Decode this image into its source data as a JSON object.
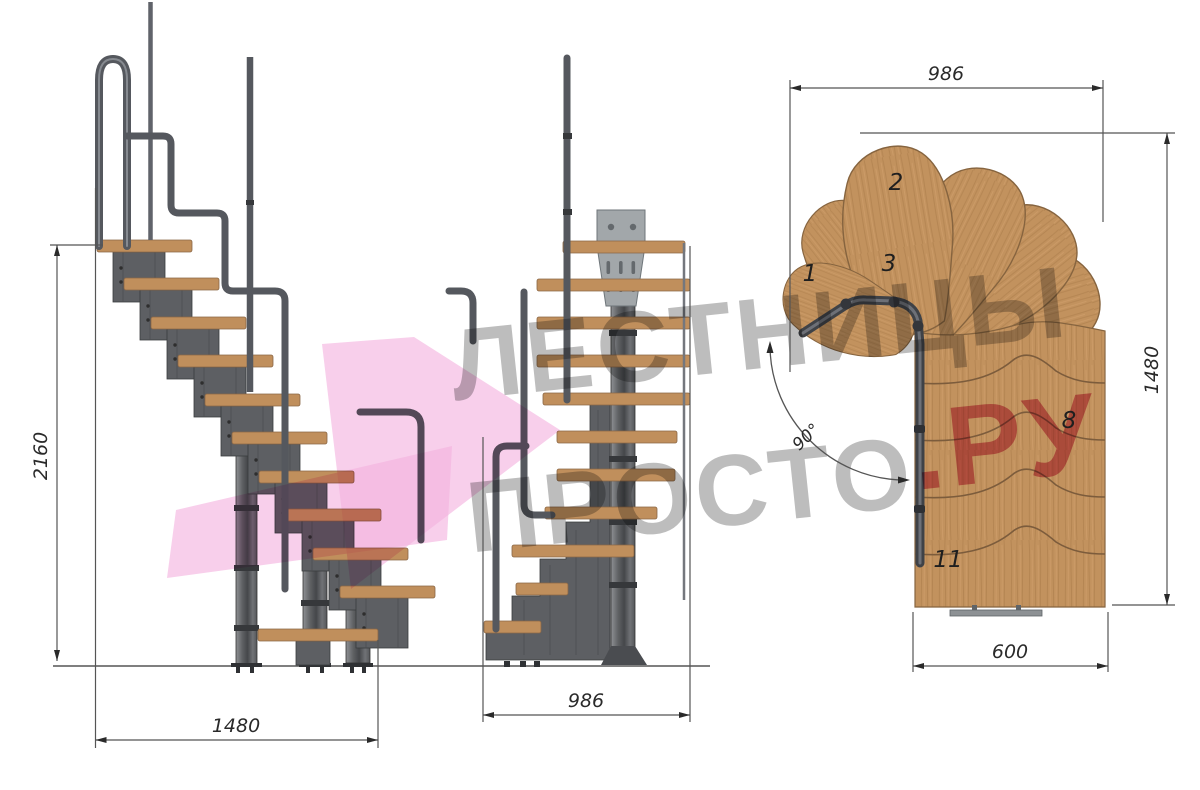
{
  "watermark": {
    "line1": "ЛЕСТНИЦЫ",
    "line2_gray": "ПРОСТО",
    "line2_pink": ".РУ",
    "text_color": "#8c8c8c",
    "pink_color": "#cd3f64",
    "arrow_color": "#f2b2dc"
  },
  "side_view": {
    "title": "side-elevation",
    "height_dim": "2160",
    "width_dim": "1480"
  },
  "front_view": {
    "title": "front-elevation",
    "width_dim": "986"
  },
  "plan_view": {
    "title": "plan",
    "top_width_dim": "986",
    "right_height_dim": "1480",
    "bottom_width_dim": "600",
    "angle_dim": "90°",
    "step_labels": [
      {
        "n": "1"
      },
      {
        "n": "2"
      },
      {
        "n": "3"
      },
      {
        "n": "8"
      },
      {
        "n": "11"
      }
    ]
  },
  "colors": {
    "wood": "#c2925e",
    "metal": "#5d5f63",
    "rail": "#55585e",
    "dimension_line": "#555555",
    "background": "#ffffff"
  }
}
